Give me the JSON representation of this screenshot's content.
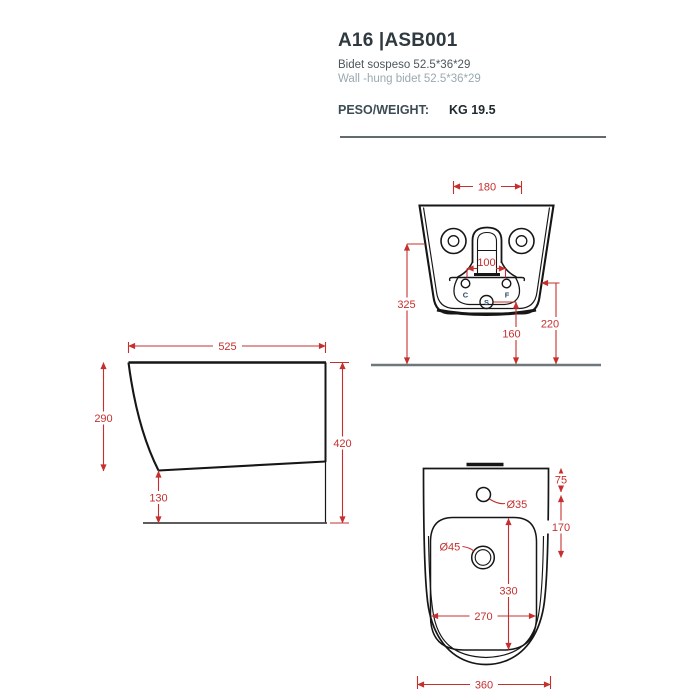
{
  "header": {
    "model_code": "A16 |ASB001",
    "description_it": "Bidet sospeso 52.5*36*29",
    "description_en": "Wall -hung bidet 52.5*36*29",
    "weight_label": "PESO/WEIGHT:",
    "weight_value": "KG 19.5"
  },
  "views": {
    "rear": {
      "dims": {
        "fixing_holes_spacing": "180",
        "supply_holes_spacing": "100",
        "fixing_holes_height": "325",
        "rim_side_height": "220",
        "drain_height": "160"
      },
      "ports": {
        "cold": "C",
        "hot": "F",
        "drain": "S"
      }
    },
    "side": {
      "dims": {
        "depth": "525",
        "front_height": "290",
        "bottom_clearance": "130",
        "overall_height": "420"
      }
    },
    "plan": {
      "dims": {
        "tap_hole_offset": "75",
        "tap_to_drain": "170",
        "tap_hole_diameter": "Ø35",
        "drain_diameter": "Ø45",
        "basin_length": "330",
        "basin_width": "270",
        "overall_width": "360"
      }
    }
  },
  "colors": {
    "dimension_red": "#c5302f",
    "ink": "#161616",
    "floor_gray": "#6e787c",
    "port_navy": "#2b4a6b"
  }
}
